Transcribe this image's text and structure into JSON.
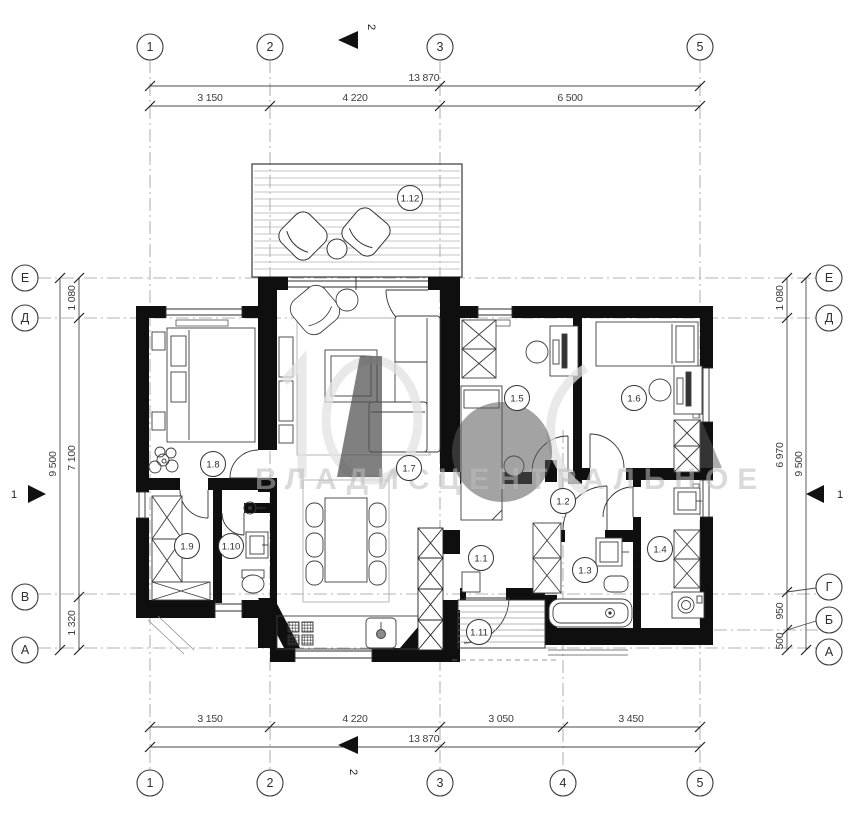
{
  "title": "floor-plan-drawing",
  "watermark": {
    "text": "ВЛАДИСЦЕНТРАЛЬНОЕ"
  },
  "axes": {
    "top": [
      "1",
      "2",
      "3",
      "5"
    ],
    "bottom": [
      "1",
      "2",
      "3",
      "4",
      "5"
    ],
    "left": [
      "Е",
      "Д",
      "В",
      "А"
    ],
    "right": [
      "Е",
      "Д",
      "Г",
      "Б",
      "А"
    ]
  },
  "section": {
    "h_label": "1",
    "v_label": "2"
  },
  "dimensions": {
    "top": {
      "total": "13 870",
      "segments": [
        "3 150",
        "4 220",
        "6 500"
      ]
    },
    "bottom": {
      "total": "13 870",
      "segments": [
        "3 150",
        "4 220",
        "3 050",
        "3 450"
      ]
    },
    "left": {
      "total": "9 500",
      "segments": [
        "1 080",
        "7 100",
        "1 320"
      ]
    },
    "right": {
      "total": "9 500",
      "segments": [
        "1 080",
        "6 970",
        "950",
        "500"
      ]
    }
  },
  "rooms": [
    "1.1",
    "1.2",
    "1.3",
    "1.4",
    "1.5",
    "1.6",
    "1.7",
    "1.8",
    "1.9",
    "1.10",
    "1.11",
    "1.12"
  ],
  "colors": {
    "wall": "#0f0f0f",
    "line": "#333333",
    "grid": "#9a9a9a",
    "light": "#b3b3b3"
  }
}
